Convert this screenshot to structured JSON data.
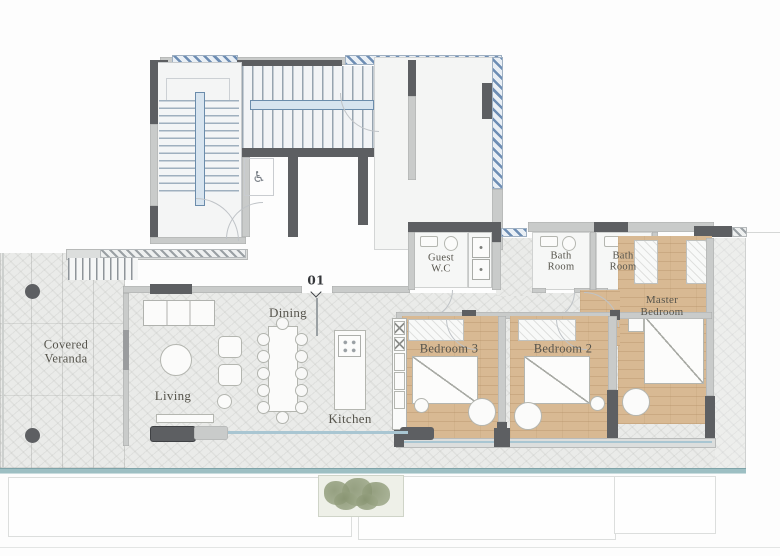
{
  "floor_plan": {
    "unit_marker": "01",
    "labels": {
      "covered_veranda_1": "Covered",
      "covered_veranda_2": "Veranda",
      "living": "Living",
      "dining": "Dining",
      "kitchen": "Kitchen",
      "guest_wc_1": "Guest",
      "guest_wc_2": "W.C",
      "bath1_1": "Bath",
      "bath1_2": "Room",
      "bath2_1": "Bath",
      "bath2_2": "Room",
      "bedroom3": "Bedroom 3",
      "bedroom2": "Bedroom 2",
      "master_1": "Master",
      "master_2": "Bedroom"
    },
    "icons": {
      "accessible": "♿"
    },
    "colors": {
      "wall_dark": "#5d5f62",
      "wall_light": "#c9cbca",
      "hatch_blue": "#6d8db4",
      "stone_floor": "#eaebe9",
      "wood_floor": "#d8b993",
      "glass_blue": "#a9c6d2",
      "terrace_edge": "#9dbfc3",
      "label_text": "#56544c",
      "plant_green": "#93a07e"
    }
  }
}
